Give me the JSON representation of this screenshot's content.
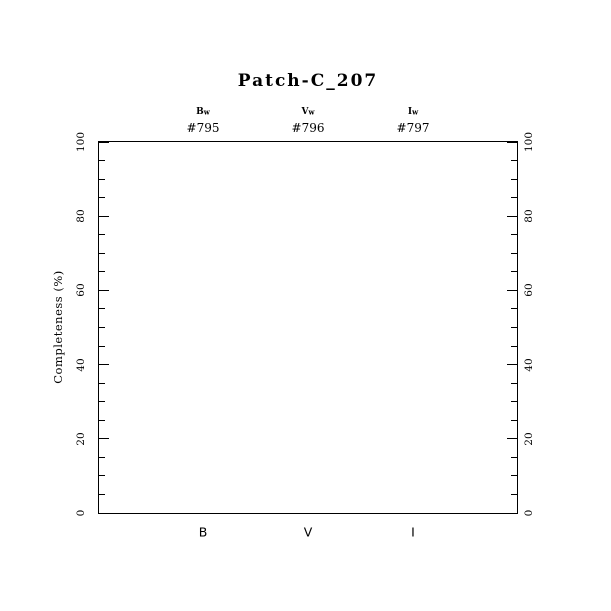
{
  "colors": {
    "foreground": "#000000",
    "background": "#ffffff"
  },
  "chart_data": {
    "type": "scatter",
    "title": "Patch-C_207",
    "ylabel": "Completeness (%)",
    "xlabel": "",
    "ylim": [
      0,
      100
    ],
    "y_major_ticks": [
      0,
      20,
      40,
      60,
      80,
      100
    ],
    "y_minor_tick_step": 5,
    "grid": false,
    "legend": null,
    "series": [],
    "plot_area_empty": true,
    "bands": [
      {
        "filter_base": "B",
        "filter_sub": "w",
        "frame_id": "#795",
        "x_label": "B"
      },
      {
        "filter_base": "V",
        "filter_sub": "w",
        "frame_id": "#796",
        "x_label": "V"
      },
      {
        "filter_base": "I",
        "filter_sub": "w",
        "frame_id": "#797",
        "x_label": "I"
      }
    ]
  }
}
